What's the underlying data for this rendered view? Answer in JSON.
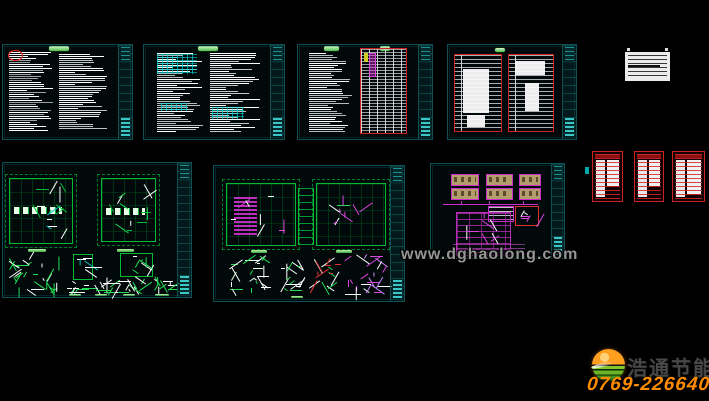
{
  "canvas": {
    "background": "#000000",
    "width": 709,
    "height": 401
  },
  "watermark": {
    "text": "www.dghaolong.com",
    "color": "#969696"
  },
  "branding": {
    "company_name": "浩通节能",
    "phone": "0769-22664029",
    "logo_icon": "globe-sphere-icon",
    "orange": "#ff8c00",
    "green": "#6ab526",
    "name_color": "#474747"
  },
  "palette": {
    "sheet_border": "#0d5156",
    "title_strip": "#106e6e",
    "text_bright": "#ffffff",
    "text_dim": "#9aa4a4",
    "cad_green": "#00bb33",
    "cad_magenta": "#cc22cc",
    "cad_red": "#cc2222",
    "cad_cyan": "#00c2c2",
    "tan_block": "#b39e6b",
    "paper_white": "#ececec",
    "green_label": "#4fbf4a"
  },
  "sheets": [
    {
      "id": "sheet-notes-1"
    },
    {
      "id": "sheet-notes-2"
    },
    {
      "id": "sheet-notes-schedule-3"
    },
    {
      "id": "sheet-schedules-4"
    },
    {
      "id": "sheet-plans-5"
    },
    {
      "id": "sheet-plans-6"
    },
    {
      "id": "sheet-system-7"
    },
    {
      "id": "material-card"
    },
    {
      "id": "red-mini-1"
    },
    {
      "id": "red-mini-2"
    },
    {
      "id": "red-mini-3"
    }
  ]
}
